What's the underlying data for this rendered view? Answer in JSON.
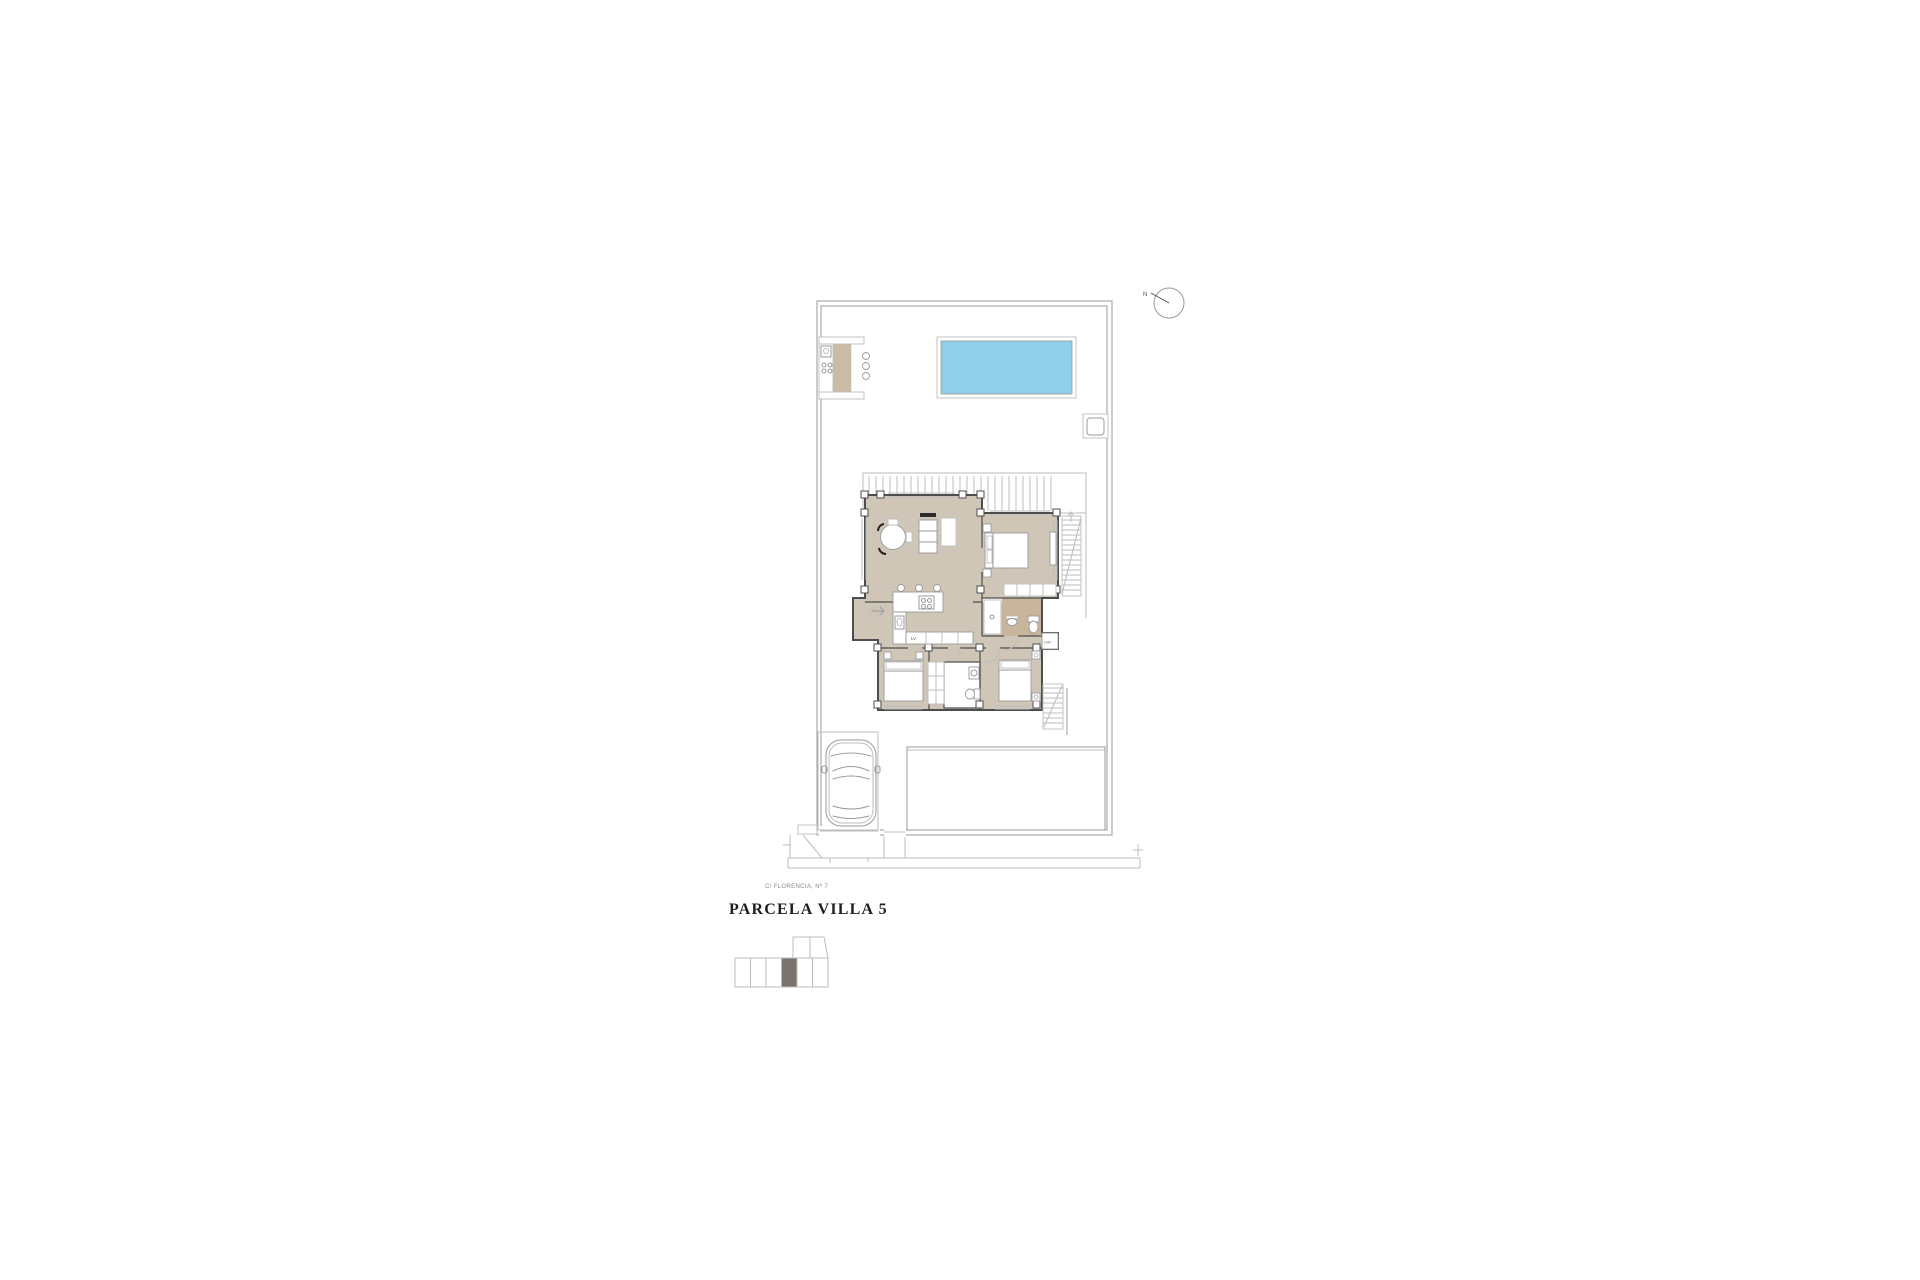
{
  "title": "PARCELA VILLA 5",
  "address": "C/ FLORENCIA, Nº 7",
  "compass": {
    "label": "N"
  },
  "room_labels": {
    "dishwasher": "LV",
    "laundry": "LVD"
  },
  "site": {
    "bottom_row_units": 6,
    "top_row_units": 2,
    "highlighted_unit": 4
  },
  "colors": {
    "floor_tan": "#cfc6b8",
    "bath_tan": "#c8b59b",
    "pool_blue": "#8fd0e8",
    "wood_tan": "#cbbba4",
    "keyplan_fill": "#7a736d",
    "wall_dark": "#4d4d4d",
    "line_light": "#bdbdbd",
    "line_mid": "#9a9a9a",
    "text_dark": "#1f1f1f",
    "text_gray": "#8a8a8a"
  }
}
